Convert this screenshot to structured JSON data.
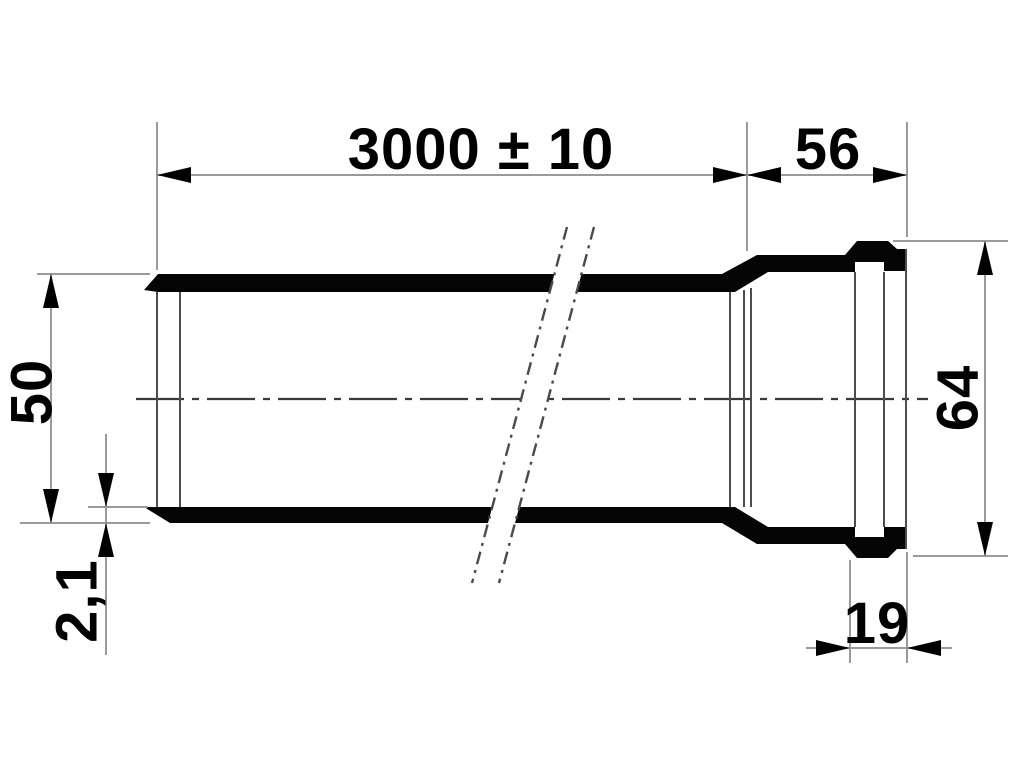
{
  "drawing": {
    "description": "Technical dimension drawing of a plastic sewage pipe with push-fit socket and sealing bead",
    "background_color": "#ffffff",
    "ink_color": "#000000",
    "dimension_line_color": "#9a9a9a",
    "dimensions": {
      "total_length": "3000 ± 10",
      "socket_length": "56",
      "pipe_outer_diameter": "50",
      "wall_thickness": "2,1",
      "socket_outer_diameter": "64",
      "socket_mouth_to_bead": "19"
    }
  }
}
